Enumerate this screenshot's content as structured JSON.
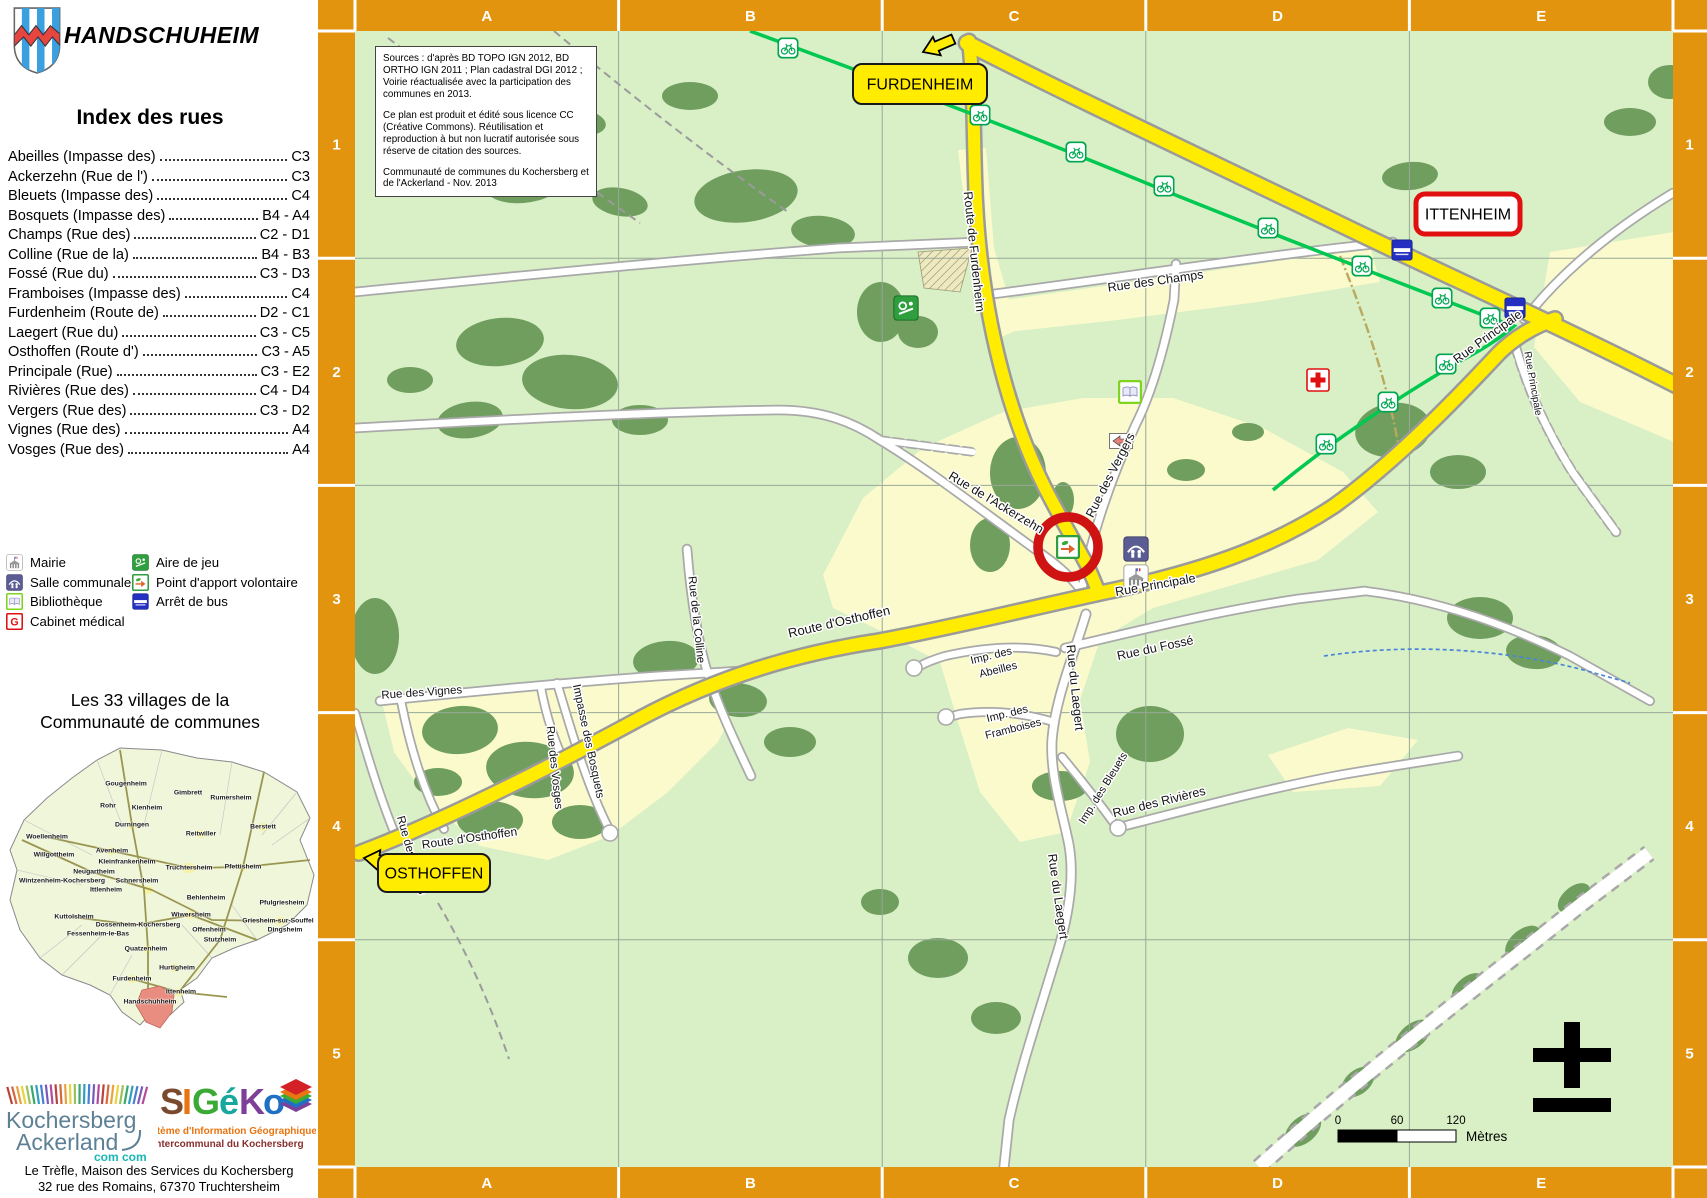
{
  "colors": {
    "accent_orange": "#E2940E",
    "road_yellow": "#FFEC00",
    "cycle_green": "#00C850",
    "highlight_red": "#CF1313",
    "map_green": "#D9EFC5",
    "urban_yellow": "#FAFACD",
    "forest_green": "#6F9E5F"
  },
  "sidebar": {
    "title": "HANDSCHUHEIM",
    "index_heading": "Index des rues",
    "index": [
      {
        "name": "Abeilles (Impasse des)",
        "ref": "C3"
      },
      {
        "name": "Ackerzehn (Rue de l')",
        "ref": "C3"
      },
      {
        "name": "Bleuets (Impasse des)",
        "ref": "C4"
      },
      {
        "name": "Bosquets (Impasse des)",
        "ref": "B4 - A4"
      },
      {
        "name": "Champs (Rue des)",
        "ref": "C2 - D1"
      },
      {
        "name": "Colline (Rue de la)",
        "ref": "B4 - B3"
      },
      {
        "name": "Fossé (Rue du)",
        "ref": "C3 - D3"
      },
      {
        "name": "Framboises (Impasse des)",
        "ref": "C4"
      },
      {
        "name": "Furdenheim (Route de)",
        "ref": "D2 - C1"
      },
      {
        "name": "Laegert (Rue du)",
        "ref": "C3 - C5"
      },
      {
        "name": "Osthoffen (Route d')",
        "ref": "C3 - A5"
      },
      {
        "name": "Principale (Rue)",
        "ref": "C3 - E2"
      },
      {
        "name": "Rivières (Rue des)",
        "ref": "C4 - D4"
      },
      {
        "name": "Vergers (Rue des)",
        "ref": "C3 - D2"
      },
      {
        "name": "Vignes (Rue des)",
        "ref": "A4"
      },
      {
        "name": "Vosges (Rue des)",
        "ref": "A4"
      }
    ],
    "legend": {
      "col1": [
        {
          "icon": "mairie",
          "label": "Mairie"
        },
        {
          "icon": "salle",
          "label": "Salle communale"
        },
        {
          "icon": "book",
          "label": "Bibliothèque"
        },
        {
          "icon": "g",
          "label": "Cabinet médical"
        }
      ],
      "col2": [
        {
          "icon": "play",
          "label": "Aire de jeu"
        },
        {
          "icon": "pav",
          "label": "Point d'apport volontaire"
        },
        {
          "icon": "bus",
          "label": "Arrêt de bus"
        }
      ]
    },
    "villages_heading_1": "Les 33 villages de la",
    "villages_heading_2": "Communauté de communes",
    "villages": [
      {
        "n": "Gougenheim",
        "x": 124,
        "y": 49
      },
      {
        "n": "Gimbrett",
        "x": 186,
        "y": 58
      },
      {
        "n": "Rumersheim",
        "x": 229,
        "y": 63
      },
      {
        "n": "Rohr",
        "x": 106,
        "y": 71
      },
      {
        "n": "Kienheim",
        "x": 145,
        "y": 73
      },
      {
        "n": "Durningen",
        "x": 130,
        "y": 90
      },
      {
        "n": "Reitwiller",
        "x": 199,
        "y": 99
      },
      {
        "n": "Berstett",
        "x": 261,
        "y": 92
      },
      {
        "n": "Woellenheim",
        "x": 45,
        "y": 102
      },
      {
        "n": "Willgottheim",
        "x": 52,
        "y": 120
      },
      {
        "n": "Avenheim",
        "x": 110,
        "y": 116
      },
      {
        "n": "Kleinfrankenheim",
        "x": 125,
        "y": 127
      },
      {
        "n": "Truchtersheim",
        "x": 187,
        "y": 133
      },
      {
        "n": "Pfettisheim",
        "x": 241,
        "y": 132
      },
      {
        "n": "Neugartheim",
        "x": 92,
        "y": 137
      },
      {
        "n": "Wintzenheim-Kochersberg",
        "x": 60,
        "y": 146
      },
      {
        "n": "Schnersheim",
        "x": 135,
        "y": 146
      },
      {
        "n": "Ittlenheim",
        "x": 104,
        "y": 155
      },
      {
        "n": "Behlenheim",
        "x": 204,
        "y": 163
      },
      {
        "n": "Pfulgriesheim",
        "x": 280,
        "y": 168
      },
      {
        "n": "Kuttolsheim",
        "x": 72,
        "y": 182
      },
      {
        "n": "Wiwersheim",
        "x": 189,
        "y": 180
      },
      {
        "n": "Dossenheim-Kochersberg",
        "x": 136,
        "y": 190
      },
      {
        "n": "Griesheim-sur-Souffel",
        "x": 276,
        "y": 186
      },
      {
        "n": "Fessenheim-le-Bas",
        "x": 96,
        "y": 199
      },
      {
        "n": "Offenheim",
        "x": 207,
        "y": 195
      },
      {
        "n": "Dingsheim",
        "x": 283,
        "y": 195
      },
      {
        "n": "Stutzheim",
        "x": 218,
        "y": 205
      },
      {
        "n": "Quatzenheim",
        "x": 144,
        "y": 214
      },
      {
        "n": "Hurtigheim",
        "x": 175,
        "y": 233
      },
      {
        "n": "Furdenheim",
        "x": 130,
        "y": 244
      },
      {
        "n": "Ittenheim",
        "x": 179,
        "y": 257
      },
      {
        "n": "Handschuhheim",
        "x": 148,
        "y": 267,
        "hl": true
      }
    ],
    "logo_kochersberg": {
      "line1": "Kochersberg",
      "line2": "Ackerland",
      "badge": "com com"
    },
    "logo_sigeko": {
      "letters": [
        {
          "c": "S",
          "col": "#7a4a2f"
        },
        {
          "c": "I",
          "col": "#e87511"
        },
        {
          "c": "G",
          "col": "#3aaa35"
        },
        {
          "c": "é",
          "col": "#18a79c"
        },
        {
          "c": "K",
          "col": "#7d3f98"
        },
        {
          "c": "o",
          "col": "#1f6fc4"
        }
      ],
      "sub1": "Système d'Information Géographique",
      "sub2": "Intercommunal du Kochersberg"
    },
    "address1": "Le Trèfle, Maison des Services du Kochersberg",
    "address2": "32 rue des Romains, 67370 Truchtersheim"
  },
  "map": {
    "columns": [
      "A",
      "B",
      "C",
      "D",
      "E"
    ],
    "rows": [
      "1",
      "2",
      "3",
      "4",
      "5"
    ],
    "sources": [
      "Sources : d'après BD TOPO IGN 2012, BD ORTHO IGN 2011 ; Plan cadastral DGI 2012 ; Voirie réactualisée avec la participation des communes en 2013.",
      "Ce plan est produit et édité sous licence CC (Créative Commons). Réutilisation et reproduction à but non lucratif autorisée sous réserve de citation des sources.",
      "Communauté de communes du Kochersberg et de l'Ackerland - Nov. 2013"
    ],
    "places": [
      {
        "text": "FURDENHEIM",
        "style": "yellow",
        "x": 535,
        "y": 64,
        "w": 134,
        "h": 40
      },
      {
        "text": "ITTENHEIM",
        "style": "red",
        "x": 1098,
        "y": 194,
        "w": 104,
        "h": 40
      },
      {
        "text": "OSTHOFFEN",
        "style": "yellow",
        "x": 60,
        "y": 854,
        "w": 112,
        "h": 38
      }
    ],
    "streets": [
      {
        "t": "Route de Furdenheim",
        "x": 652,
        "y": 252,
        "r": 84
      },
      {
        "t": "Rue des Champs",
        "x": 838,
        "y": 285,
        "r": -8
      },
      {
        "t": "Rue Principale",
        "x": 838,
        "y": 589,
        "r": -10
      },
      {
        "t": "Rue Principale",
        "x": 1172,
        "y": 340,
        "r": -36
      },
      {
        "t": "Rue Principale",
        "x": 1212,
        "y": 384,
        "r": 80,
        "s": 10
      },
      {
        "t": "Rue des Vergers",
        "x": 796,
        "y": 477,
        "r": -63
      },
      {
        "t": "Rue de l'Ackerzehn",
        "x": 676,
        "y": 506,
        "r": 31
      },
      {
        "t": "Rue du Laegert",
        "x": 753,
        "y": 688,
        "r": 84
      },
      {
        "t": "Imp. des",
        "x": 674,
        "y": 659,
        "r": -14,
        "s": 11
      },
      {
        "t": "Abeilles",
        "x": 681,
        "y": 673,
        "r": -14,
        "s": 11
      },
      {
        "t": "Rue du Fossé",
        "x": 838,
        "y": 652,
        "r": -12
      },
      {
        "t": "Imp. des",
        "x": 690,
        "y": 717,
        "r": -14,
        "s": 11
      },
      {
        "t": "Framboises",
        "x": 696,
        "y": 732,
        "r": -14,
        "s": 11
      },
      {
        "t": "Imp. des Bleuets",
        "x": 788,
        "y": 790,
        "r": -58,
        "s": 11
      },
      {
        "t": "Rue des Rivières",
        "x": 842,
        "y": 806,
        "r": -14
      },
      {
        "t": "Rue du Laegert",
        "x": 736,
        "y": 897,
        "r": 82
      },
      {
        "t": "Rue des Vignes",
        "x": 104,
        "y": 696,
        "r": -4,
        "s": 11.5
      },
      {
        "t": "Rue des Vignes",
        "x": 90,
        "y": 856,
        "r": 74,
        "s": 11.5
      },
      {
        "t": "Rue des Vosges",
        "x": 233,
        "y": 768,
        "r": 84,
        "s": 11.5
      },
      {
        "t": "Impasse des Bosquets",
        "x": 267,
        "y": 742,
        "r": 78,
        "s": 11.5
      },
      {
        "t": "Rue de la Colline",
        "x": 375,
        "y": 620,
        "r": 84,
        "s": 11.5
      },
      {
        "t": "Route d'Osthoffen",
        "x": 522,
        "y": 626,
        "r": -13,
        "s": 13
      },
      {
        "t": "Route d'Osthoffen",
        "x": 152,
        "y": 842,
        "r": -8,
        "s": 12
      }
    ],
    "poi": [
      {
        "k": "play",
        "x": 588,
        "y": 308
      },
      {
        "k": "book",
        "x": 812,
        "y": 392
      },
      {
        "k": "cross",
        "x": 1000,
        "y": 380
      },
      {
        "k": "bus",
        "x": 1197,
        "y": 308
      },
      {
        "k": "bus",
        "x": 1084,
        "y": 250
      },
      {
        "k": "salle",
        "x": 818,
        "y": 549
      },
      {
        "k": "mairie",
        "x": 818,
        "y": 577
      },
      {
        "k": "pav",
        "x": 750,
        "y": 547
      },
      {
        "k": "oneway",
        "x": 803,
        "y": 441
      }
    ],
    "bikes": [
      [
        470,
        48
      ],
      [
        578,
        86
      ],
      [
        662,
        115
      ],
      [
        758,
        152
      ],
      [
        846,
        186
      ],
      [
        950,
        228
      ],
      [
        1044,
        266
      ],
      [
        1124,
        298
      ],
      [
        1172,
        318
      ],
      [
        1128,
        364
      ],
      [
        1070,
        402
      ],
      [
        1008,
        444
      ]
    ],
    "scale": {
      "ticks": [
        "0",
        "60",
        "120"
      ],
      "unit": "Mètres"
    }
  }
}
